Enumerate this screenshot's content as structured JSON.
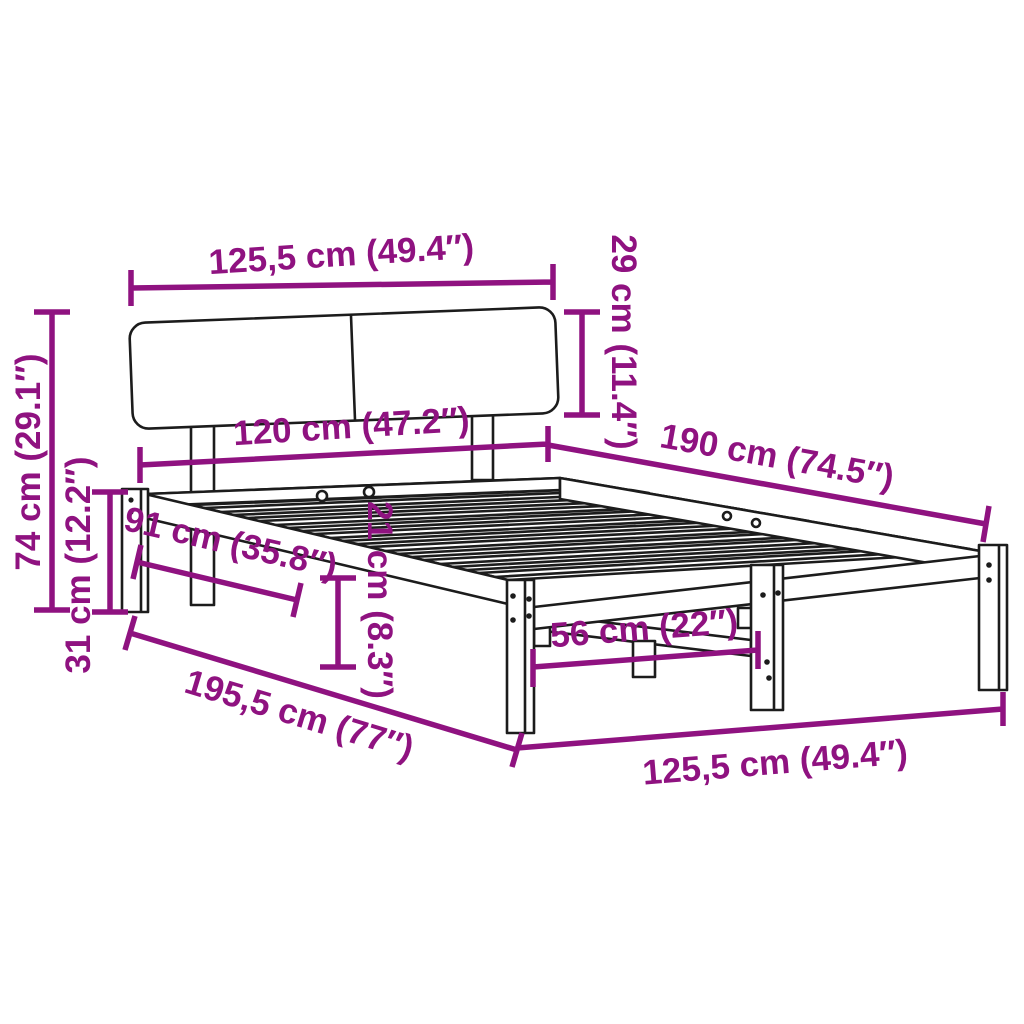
{
  "meta": {
    "title": "Bed frame dimension diagram",
    "product": "Bed frame with headboard and slatted base"
  },
  "colors": {
    "accent": "#8F1280",
    "ink": "#1C1C1C",
    "background": "#FFFFFF"
  },
  "dimensions": {
    "headboard_width": "125,5 cm (49.4″)",
    "headboard_height": "29 cm (11.4″)",
    "slat_base_width": "120 cm (47.2″)",
    "bed_length": "190 cm (74.5″)",
    "total_height": "74 cm (29.1″)",
    "frame_height": "31 cm (12.2″)",
    "side_rail_length": "91 cm (35.8″)",
    "under_bed_clearance": "21 cm (8.3″)",
    "total_length": "195,5 cm (77″)",
    "leg_spacing": "56 cm (22″)",
    "frame_width": "125,5 cm (49.4″)"
  }
}
